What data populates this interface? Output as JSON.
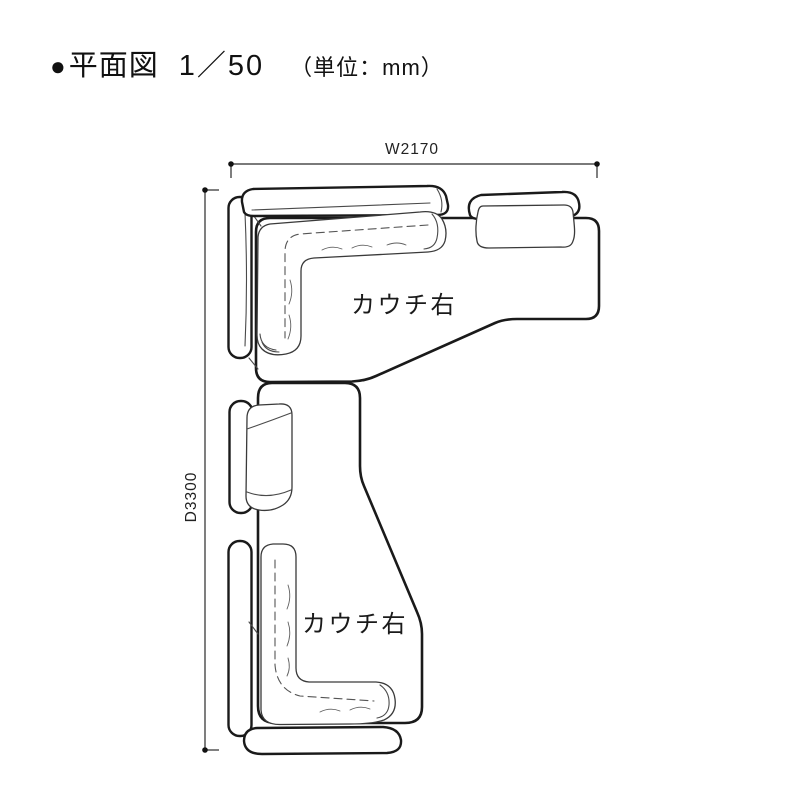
{
  "header": {
    "bullet": "●",
    "title": "平面図",
    "scale": "1／50",
    "unit": "（単位：mm）"
  },
  "plan": {
    "width_dimension": "W2170",
    "depth_dimension": "D3300",
    "couch_top_label": "カウチ右",
    "couch_bottom_label": "カウチ右"
  },
  "colors": {
    "background": "#ffffff",
    "outline": "#1a1a1a",
    "detail_line": "#4a4a4a",
    "dimension_line": "#2a2a2a"
  }
}
